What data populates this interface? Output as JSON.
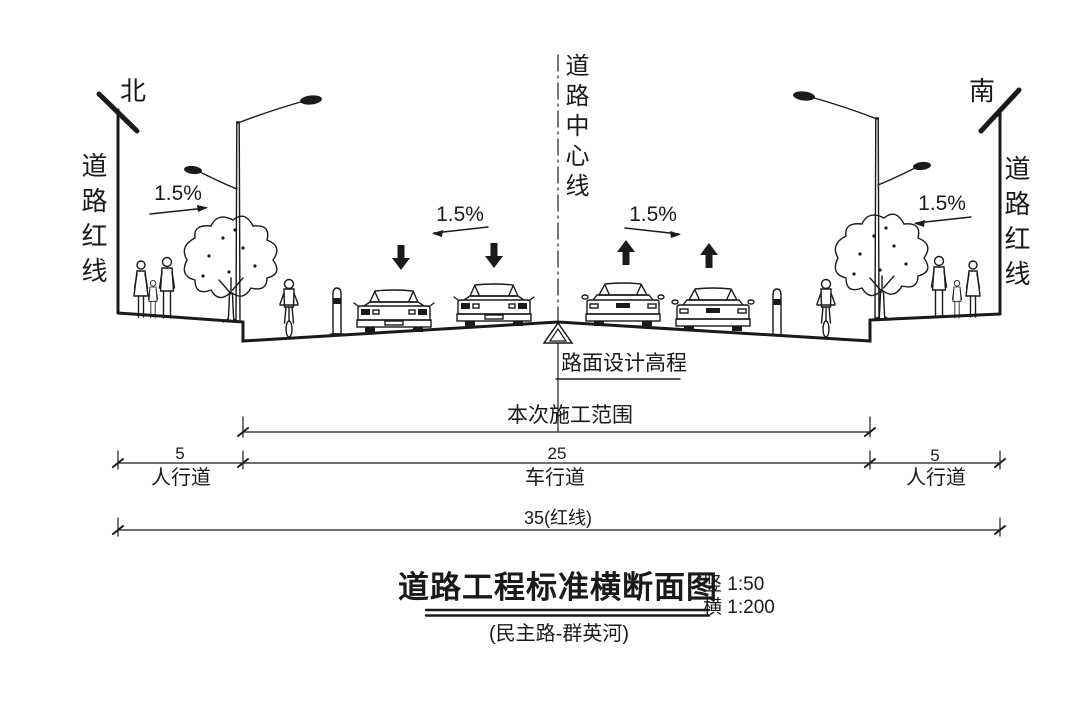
{
  "colors": {
    "ink": "#1a1a1a",
    "background": "#ffffff"
  },
  "section": {
    "north_label": "北",
    "south_label": "南",
    "redline_left": "道路红线",
    "redline_right": "道路红线",
    "centerline": "道路中心线",
    "elevation_note": "路面设计高程",
    "construction_note": "本次施工范围",
    "slopes": {
      "sidewalk_left": "1.5%",
      "lane_left": "1.5%",
      "lane_right": "1.5%",
      "sidewalk_right": "1.5%"
    }
  },
  "dimensions": {
    "sidewalk_left": {
      "value": "5",
      "label": "人行道"
    },
    "carriageway": {
      "value": "25",
      "label": "车行道"
    },
    "sidewalk_right": {
      "value": "5",
      "label": "人行道"
    },
    "total": "35(红线)"
  },
  "titleblock": {
    "title": "道路工程标准横断面图",
    "scale_vertical": "竖 1:50",
    "scale_horizontal": "横 1:200",
    "subtitle": "(民主路-群英河)"
  }
}
